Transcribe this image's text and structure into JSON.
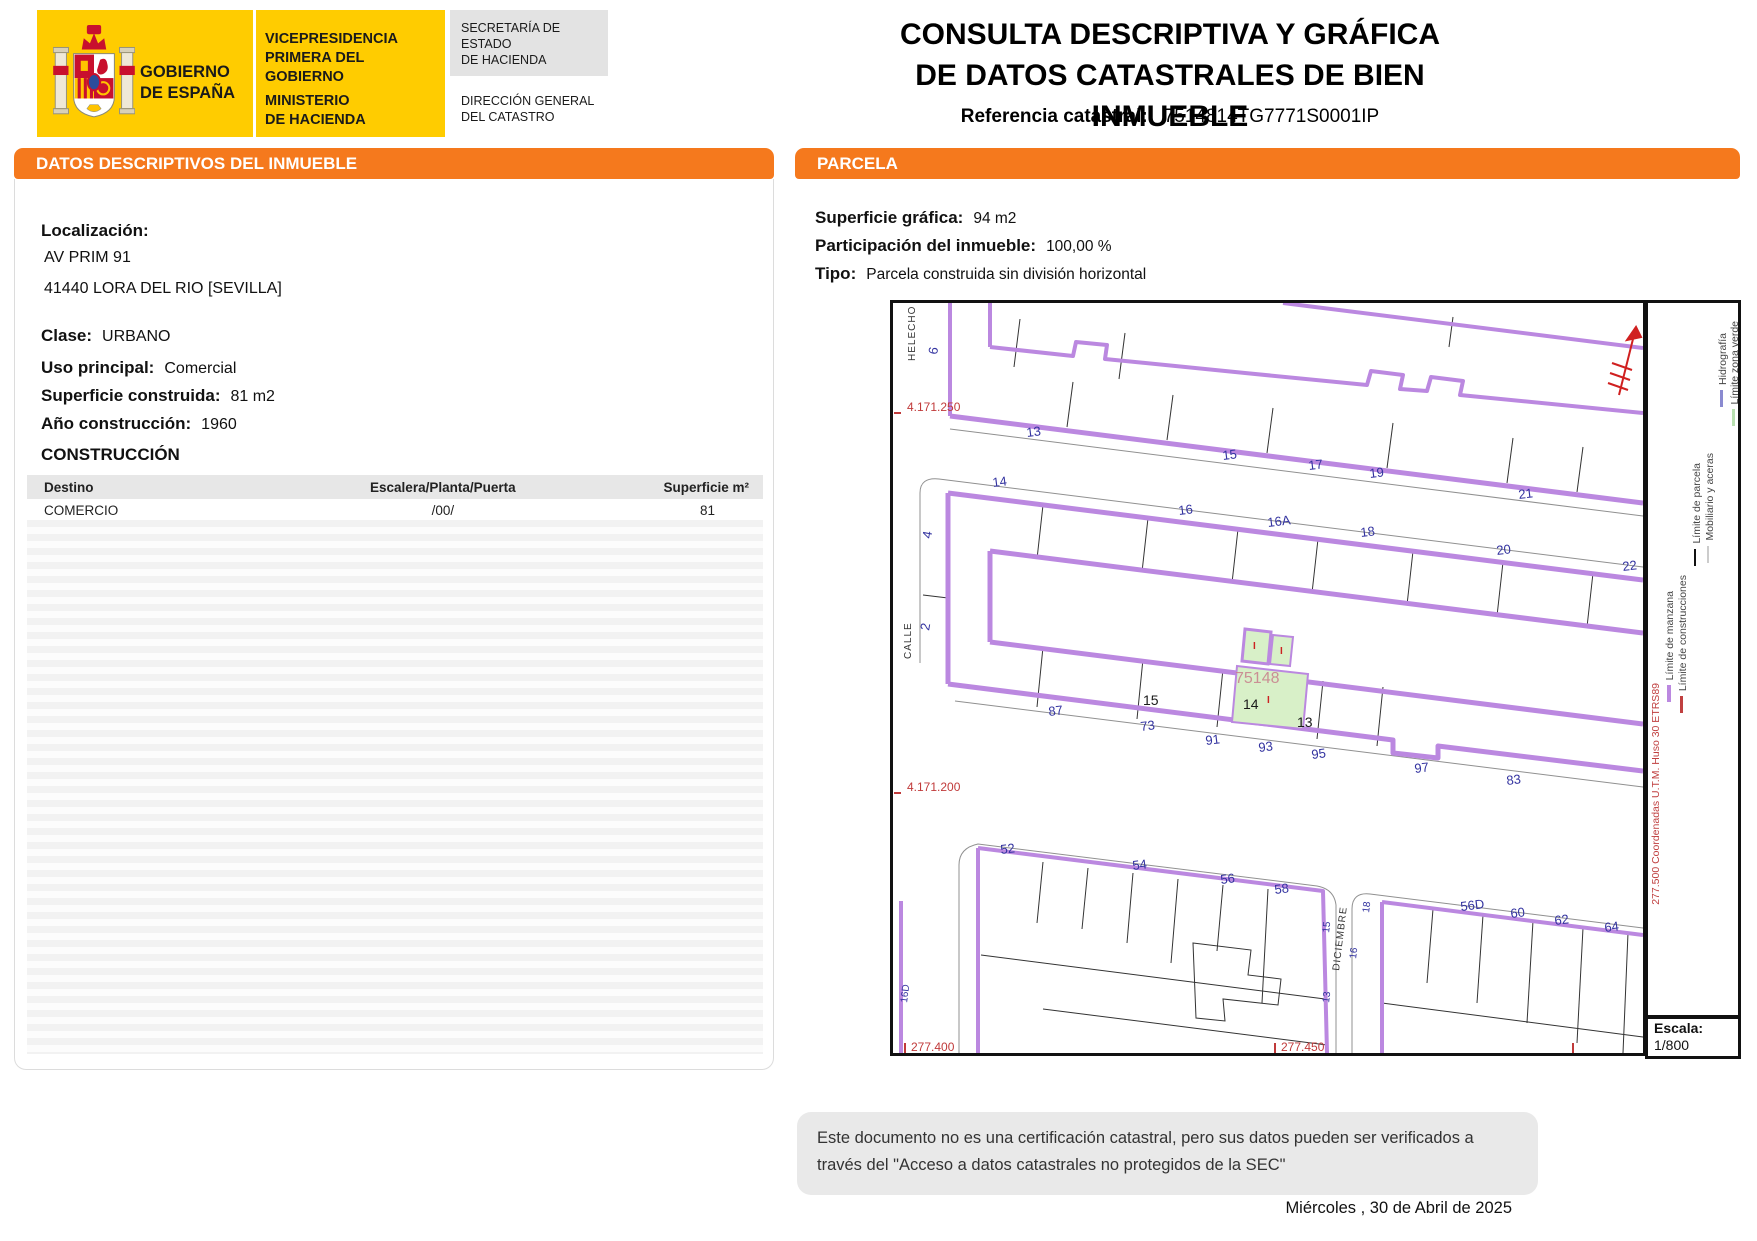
{
  "colors": {
    "accent_orange": "#F5791D",
    "brand_yellow": "#FFCC00",
    "map_purple": "#BB88E0",
    "parcel_green": "#D8F0C8",
    "map_red": "#C03A3A",
    "map_blue": "#3333A0"
  },
  "header": {
    "gobierno_line1": "GOBIERNO",
    "gobierno_line2": "DE ESPAÑA",
    "vice_line1": "VICEPRESIDENCIA",
    "vice_line2": "PRIMERA DEL GOBIERNO",
    "ministerio_line1": "MINISTERIO",
    "ministerio_line2": "DE HACIENDA",
    "secretaria_line1": "SECRETARÍA DE ESTADO",
    "secretaria_line2": "DE HACIENDA",
    "direccion_line1": "DIRECCIÓN GENERAL",
    "direccion_line2": "DEL CATASTRO",
    "title_line1": "CONSULTA DESCRIPTIVA Y GRÁFICA",
    "title_line2": "DE DATOS CATASTRALES DE BIEN INMUEBLE",
    "ref_label": "Referencia catastral:",
    "ref_value": "7514814TG7771S0001IP"
  },
  "left_panel": {
    "title": "DATOS DESCRIPTIVOS DEL INMUEBLE",
    "localizacion_label": "Localización:",
    "address_line1": "AV PRIM 91",
    "address_line2": "41440 LORA DEL RIO [SEVILLA]",
    "fields": [
      {
        "label": "Clase:",
        "value": "URBANO"
      },
      {
        "label": "Uso principal:",
        "value": "Comercial"
      },
      {
        "label": "Superficie construida:",
        "value": "81 m2"
      },
      {
        "label": "Año construcción:",
        "value": "1960"
      }
    ],
    "construccion_title": "CONSTRUCCIÓN",
    "table": {
      "headers": [
        "Destino",
        "Escalera/Planta/Puerta",
        "Superficie m²"
      ],
      "rows": [
        [
          "COMERCIO",
          "/00/",
          "81"
        ]
      ]
    }
  },
  "right_panel": {
    "title": "PARCELA",
    "fields": [
      {
        "label": "Superficie gráfica:",
        "value": "94 m2"
      },
      {
        "label": "Participación del inmueble:",
        "value": "100,00 %"
      },
      {
        "label": "Tipo:",
        "value": "Parcela construida sin división horizontal"
      }
    ]
  },
  "map": {
    "subject_parcel": "75148",
    "escala_label": "Escala:",
    "escala_value": "1/800",
    "labels": [
      {
        "t": "HELECHO",
        "x": 22,
        "y": 58,
        "r": -90,
        "c": "street"
      },
      {
        "t": "6",
        "x": 44,
        "y": 52,
        "r": -80,
        "c": "blue"
      },
      {
        "t": "4.171.250",
        "x": 14,
        "y": 108,
        "r": 0,
        "c": "red"
      },
      {
        "t": "4.171.200",
        "x": 14,
        "y": 488,
        "r": 0,
        "c": "red"
      },
      {
        "t": "277.400",
        "x": 18,
        "y": 748,
        "r": 0,
        "c": "red"
      },
      {
        "t": "277.450",
        "x": 388,
        "y": 748,
        "r": 0,
        "c": "red"
      },
      {
        "t": "13",
        "x": 134,
        "y": 134,
        "r": -7,
        "c": "blue"
      },
      {
        "t": "15",
        "x": 330,
        "y": 157,
        "r": -7,
        "c": "blue"
      },
      {
        "t": "17",
        "x": 416,
        "y": 167,
        "r": -7,
        "c": "blue"
      },
      {
        "t": "19",
        "x": 477,
        "y": 175,
        "r": -7,
        "c": "blue"
      },
      {
        "t": "21",
        "x": 626,
        "y": 196,
        "r": -7,
        "c": "blue"
      },
      {
        "t": "14",
        "x": 100,
        "y": 184,
        "r": -7,
        "c": "blue"
      },
      {
        "t": "16",
        "x": 286,
        "y": 212,
        "r": -7,
        "c": "blue"
      },
      {
        "t": "16A",
        "x": 375,
        "y": 224,
        "r": -7,
        "c": "blue"
      },
      {
        "t": "18",
        "x": 468,
        "y": 234,
        "r": -7,
        "c": "blue"
      },
      {
        "t": "20",
        "x": 604,
        "y": 252,
        "r": -7,
        "c": "blue"
      },
      {
        "t": "22",
        "x": 730,
        "y": 268,
        "r": -7,
        "c": "blue"
      },
      {
        "t": "4",
        "x": 38,
        "y": 236,
        "r": -80,
        "c": "blue"
      },
      {
        "t": "2",
        "x": 36,
        "y": 328,
        "r": -80,
        "c": "blue"
      },
      {
        "t": "CALLE",
        "x": 18,
        "y": 356,
        "r": -90,
        "c": "street"
      },
      {
        "t": "75148",
        "x": 342,
        "y": 380,
        "r": 0,
        "c": "pink"
      },
      {
        "t": "15",
        "x": 250,
        "y": 402,
        "r": 0,
        "c": "black"
      },
      {
        "t": "14",
        "x": 350,
        "y": 406,
        "r": 0,
        "c": "black"
      },
      {
        "t": "13",
        "x": 404,
        "y": 424,
        "r": 0,
        "c": "black"
      },
      {
        "t": "I",
        "x": 360,
        "y": 346,
        "r": 0,
        "c": "redI"
      },
      {
        "t": "I",
        "x": 387,
        "y": 351,
        "r": 0,
        "c": "redI"
      },
      {
        "t": "I",
        "x": 374,
        "y": 400,
        "r": 0,
        "c": "redI"
      },
      {
        "t": "87",
        "x": 156,
        "y": 413,
        "r": -7,
        "c": "blue"
      },
      {
        "t": "73",
        "x": 248,
        "y": 428,
        "r": -7,
        "c": "blue"
      },
      {
        "t": "91",
        "x": 313,
        "y": 442,
        "r": -7,
        "c": "blue"
      },
      {
        "t": "93",
        "x": 366,
        "y": 449,
        "r": -7,
        "c": "blue"
      },
      {
        "t": "95",
        "x": 419,
        "y": 456,
        "r": -7,
        "c": "blue"
      },
      {
        "t": "97",
        "x": 522,
        "y": 470,
        "r": -7,
        "c": "blue"
      },
      {
        "t": "83",
        "x": 614,
        "y": 482,
        "r": -7,
        "c": "blue"
      },
      {
        "t": "52",
        "x": 108,
        "y": 551,
        "r": -7,
        "c": "blue"
      },
      {
        "t": "54",
        "x": 240,
        "y": 567,
        "r": -7,
        "c": "blue"
      },
      {
        "t": "56",
        "x": 328,
        "y": 581,
        "r": -7,
        "c": "blue"
      },
      {
        "t": "58",
        "x": 382,
        "y": 591,
        "r": -7,
        "c": "blue"
      },
      {
        "t": "56D",
        "x": 568,
        "y": 608,
        "r": -7,
        "c": "blue"
      },
      {
        "t": "60",
        "x": 618,
        "y": 615,
        "r": -7,
        "c": "blue"
      },
      {
        "t": "62",
        "x": 662,
        "y": 622,
        "r": -7,
        "c": "blue"
      },
      {
        "t": "64",
        "x": 712,
        "y": 629,
        "r": -7,
        "c": "blue"
      },
      {
        "t": "DICIEMBRE",
        "x": 446,
        "y": 668,
        "r": -83,
        "c": "street"
      },
      {
        "t": "15",
        "x": 436,
        "y": 630,
        "r": -83,
        "c": "blue-s"
      },
      {
        "t": "13",
        "x": 436,
        "y": 700,
        "r": -83,
        "c": "blue-s"
      },
      {
        "t": "16",
        "x": 463,
        "y": 656,
        "r": -83,
        "c": "blue-s"
      },
      {
        "t": "18",
        "x": 476,
        "y": 610,
        "r": -83,
        "c": "blue-s"
      },
      {
        "t": "16D",
        "x": 14,
        "y": 700,
        "r": -83,
        "c": "blue-s"
      }
    ],
    "legend": {
      "items": [
        {
          "label": "Límite de manzana",
          "color": "#BB88E0",
          "x": 16,
          "top": 288,
          "bar_w": 4
        },
        {
          "label": "Límite de construcciones",
          "color": "#C04040",
          "x": 29,
          "top": 272,
          "bar_w": 3
        },
        {
          "label": "Límite de parcela",
          "color": "#111111",
          "x": 43,
          "top": 160,
          "bar_w": 2
        },
        {
          "label": "Mobiliario y aceras",
          "color": "#CCCCCC",
          "x": 56,
          "top": 150,
          "bar_w": 2
        },
        {
          "label": "Hidrografía",
          "color": "#8A8AD0",
          "x": 69,
          "top": 30,
          "bar_w": 3
        },
        {
          "label": "Límite zona verde",
          "color": "#B8E0B0",
          "x": 81,
          "top": 18,
          "bar_w": 3
        }
      ],
      "note": {
        "text": "277.500  Coordenadas U.T.M. Huso 30 ETRS89"
      }
    }
  },
  "footer": {
    "disclaimer_line1": "Este documento no es una certificación catastral, pero sus datos pueden ser verificados a",
    "disclaimer_line2": "través del \"Acceso a datos catastrales no protegidos de la SEC\"",
    "date": "Miércoles , 30 de Abril de 2025"
  }
}
